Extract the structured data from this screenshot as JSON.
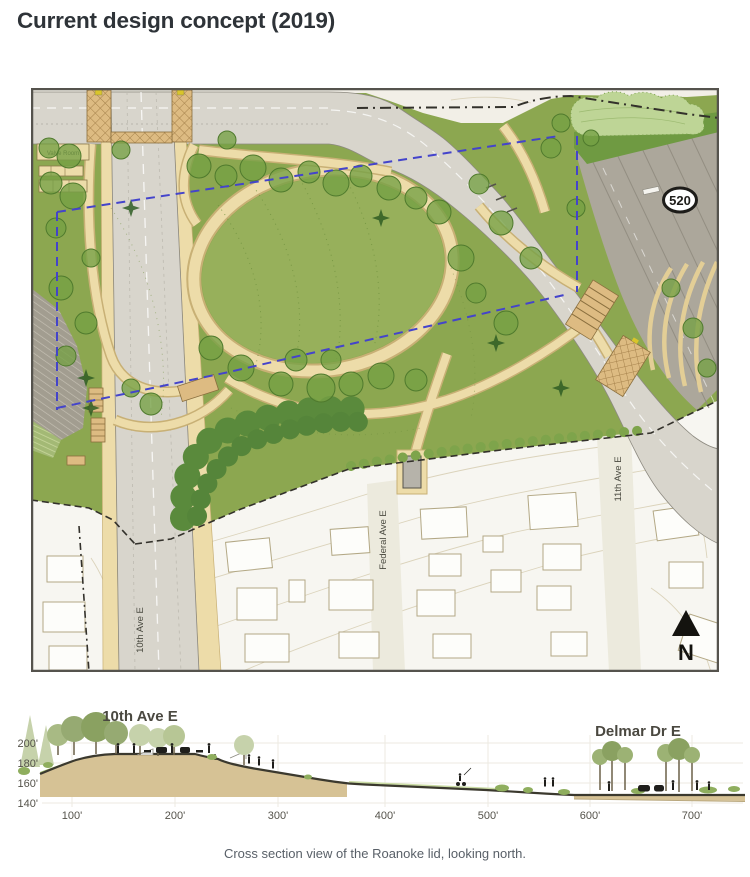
{
  "page": {
    "title": "Current design concept (2019)",
    "caption": "Cross section view of the Roanoke lid, looking north."
  },
  "map": {
    "name": "Roanoke lid site plan",
    "labels": {
      "valve_room": "Valve Room",
      "highway_shield": "520",
      "street_10th": "10th Ave E",
      "street_federal": "Federal Ave E",
      "street_11th": "11th Ave E",
      "north_arrow": "N"
    },
    "colors": {
      "park_green": "#8CA750",
      "lawn_green": "#97B05B",
      "path_tan": "#EDDCA9",
      "road_gray": "#D8D5CC",
      "highway_gray": "#ACA79B",
      "lid_boundary_blue": "#4444CB",
      "residential_white": "#F7F6F1"
    }
  },
  "cross_section": {
    "label_left": "10th Ave E",
    "label_right": "Delmar Dr E",
    "y_ticks": [
      "200'",
      "180'",
      "160'",
      "140'"
    ],
    "x_ticks": [
      "100'",
      "200'",
      "300'",
      "400'",
      "500'",
      "600'",
      "700'"
    ]
  },
  "chart_data": {
    "type": "area",
    "title": "Cross section view of the Roanoke lid, looking north.",
    "x_axis_unit": "feet (distance)",
    "y_axis_unit": "feet (elevation)",
    "x_ticks_ft": [
      100,
      200,
      300,
      400,
      500,
      600,
      700
    ],
    "y_ticks_ft": [
      200,
      180,
      160,
      140
    ],
    "annotations": [
      "10th Ave E",
      "Delmar Dr E"
    ],
    "profile": {
      "x_ft": [
        50,
        100,
        150,
        200,
        250,
        300,
        350,
        400,
        450,
        500,
        550,
        600,
        650,
        700,
        740
      ],
      "elevation_ft": [
        174,
        187,
        187,
        187,
        178,
        171,
        164,
        158,
        156,
        155,
        152,
        151,
        151,
        151,
        151
      ]
    },
    "ylim": [
      140,
      210
    ]
  }
}
